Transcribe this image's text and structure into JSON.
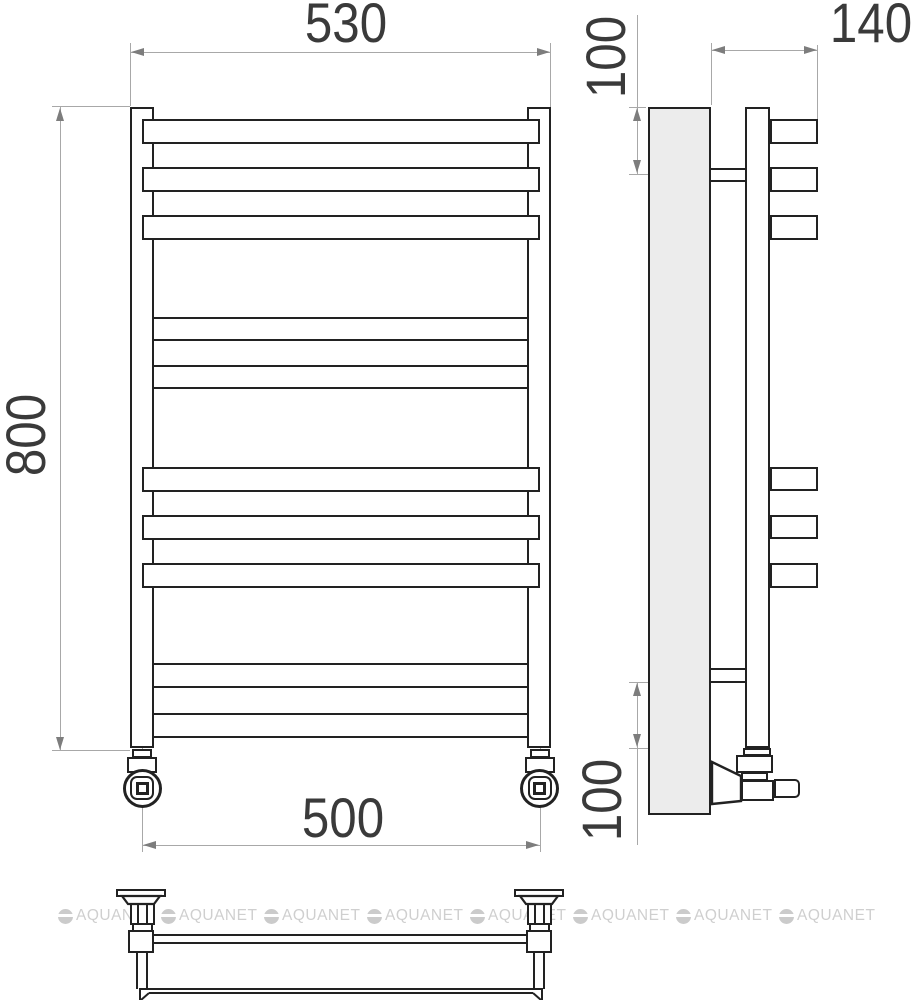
{
  "drawing": {
    "type": "heated-towel-rail-technical-drawing",
    "views": {
      "front": {
        "dim_overall_width": "530",
        "dim_overall_height": "800",
        "dim_connection_spacing": "500"
      },
      "side": {
        "dim_top_offset": "100",
        "dim_depth": "140",
        "dim_bottom_offset": "100"
      }
    },
    "watermark": {
      "text": "AQUANET"
    },
    "colors": {
      "outline": "#222222",
      "dimension_line": "#a8a8a8",
      "dimension_text": "#3a3a3a",
      "panel_fill": "#ececec",
      "watermark": "#cfcfcf",
      "background": "#ffffff"
    }
  }
}
